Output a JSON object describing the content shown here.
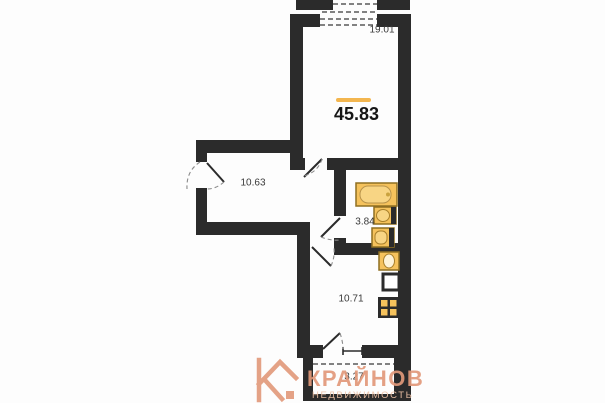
{
  "floor_plan": {
    "total_area": "45.83",
    "rooms": [
      {
        "id": "living-room",
        "area": "19.01"
      },
      {
        "id": "hallway",
        "area": "10.63"
      },
      {
        "id": "bathroom",
        "area": "3.84"
      },
      {
        "id": "kitchen",
        "area": "10.71"
      },
      {
        "id": "balcony",
        "area": "3.27"
      }
    ],
    "fixtures": [
      "bathtub",
      "washbasin",
      "toilet",
      "kitchen-sink",
      "fridge",
      "stove"
    ],
    "colors": {
      "wall": "#2b2b2b",
      "accent_line": "#f3b64f",
      "fixture_fill": "#f5c25c",
      "fixture_inner": "#f8d584",
      "fixture_border": "#8f6f22",
      "label_text": "#3a3a3a"
    }
  },
  "watermark": {
    "letter": "К",
    "brand": "КРАЙНОВ",
    "subtitle": "НЕДВИЖИМОСТЬ",
    "color": "#e2997a"
  }
}
